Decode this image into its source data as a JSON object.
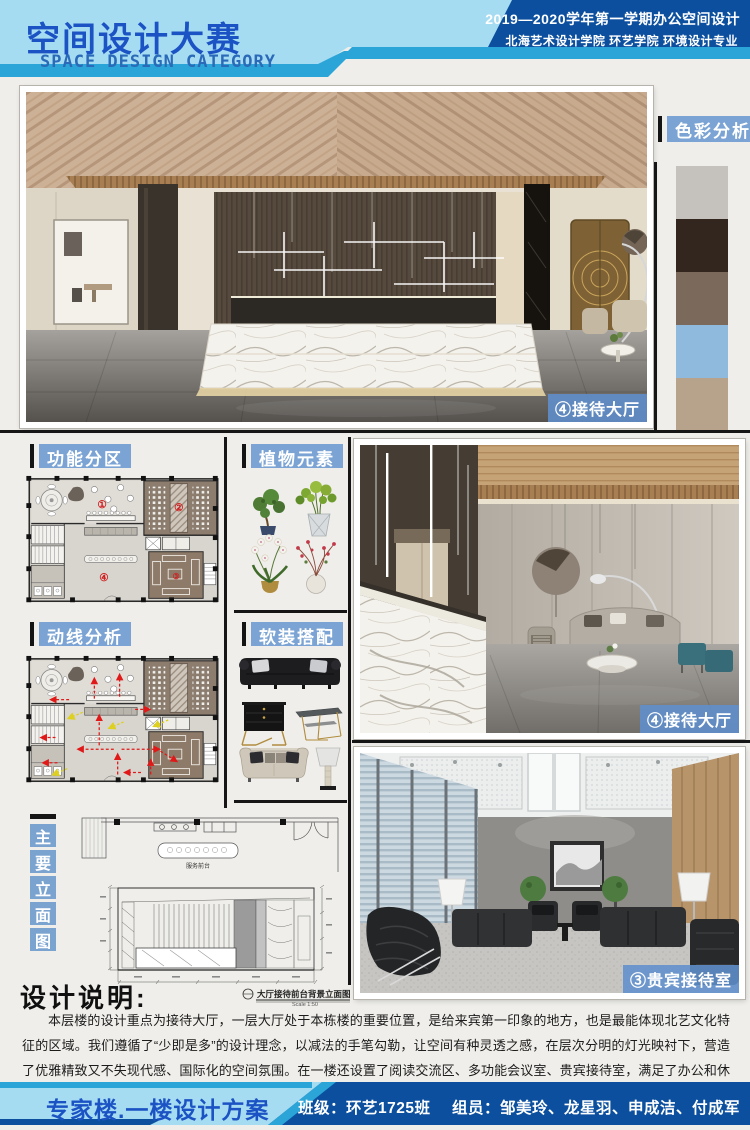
{
  "header": {
    "title": "空间设计大赛",
    "subtitle": "SPACE DESIGN CATEGORY",
    "course": "2019—2020学年第一学期办公空间设计",
    "school": "北海艺术设计学院 环艺学院 环境设计专业"
  },
  "color_analysis": {
    "label": "色彩分析",
    "swatches": [
      "#c5c1bc",
      "#32261e",
      "#7b6a5c",
      "#90b9de",
      "#b7a28c"
    ]
  },
  "sections": {
    "functional_zoning": "功能分区",
    "plants": "植物元素",
    "circulation": "动线分析",
    "furnishing": "软装搭配",
    "main_elevation_chars": [
      "主",
      "要",
      "立",
      "面",
      "图"
    ]
  },
  "plan": {
    "zones": [
      "①",
      "②",
      "③",
      "④"
    ]
  },
  "images": {
    "hero_label": "④接待大厅",
    "reception_label": "④接待大厅",
    "vip_label": "③贵宾接待室"
  },
  "elevation": {
    "desk_label": "服务前台",
    "caption": "大厅接待前台背景立面图",
    "scale": "Scale 1:50"
  },
  "description": {
    "heading": "设计说明:",
    "body": "本层楼的设计重点为接待大厅，一层大厅处于本栋楼的重要位置，是给来宾第一印象的地方，也是最能体现北艺文化特征的区域。我们遵循了“少即是多”的设计理念，以减法的手笔勾勒，让空间有种灵透之感，在层次分明的灯光映衬下，营造了优雅精致又不失现代感、国际化的空间氛围。在一楼还设置了阅读交流区、多功能会议室、贵宾接待室，满足了办公和休闲娱乐的要求，使设计更加多元化、人性化、国际化。"
  },
  "footer": {
    "project": "专家楼.一楼设计方案",
    "class_label": "班级：环艺1725班",
    "members_label": "组员：邹美玲、龙星羽、申成洁、付成军"
  }
}
